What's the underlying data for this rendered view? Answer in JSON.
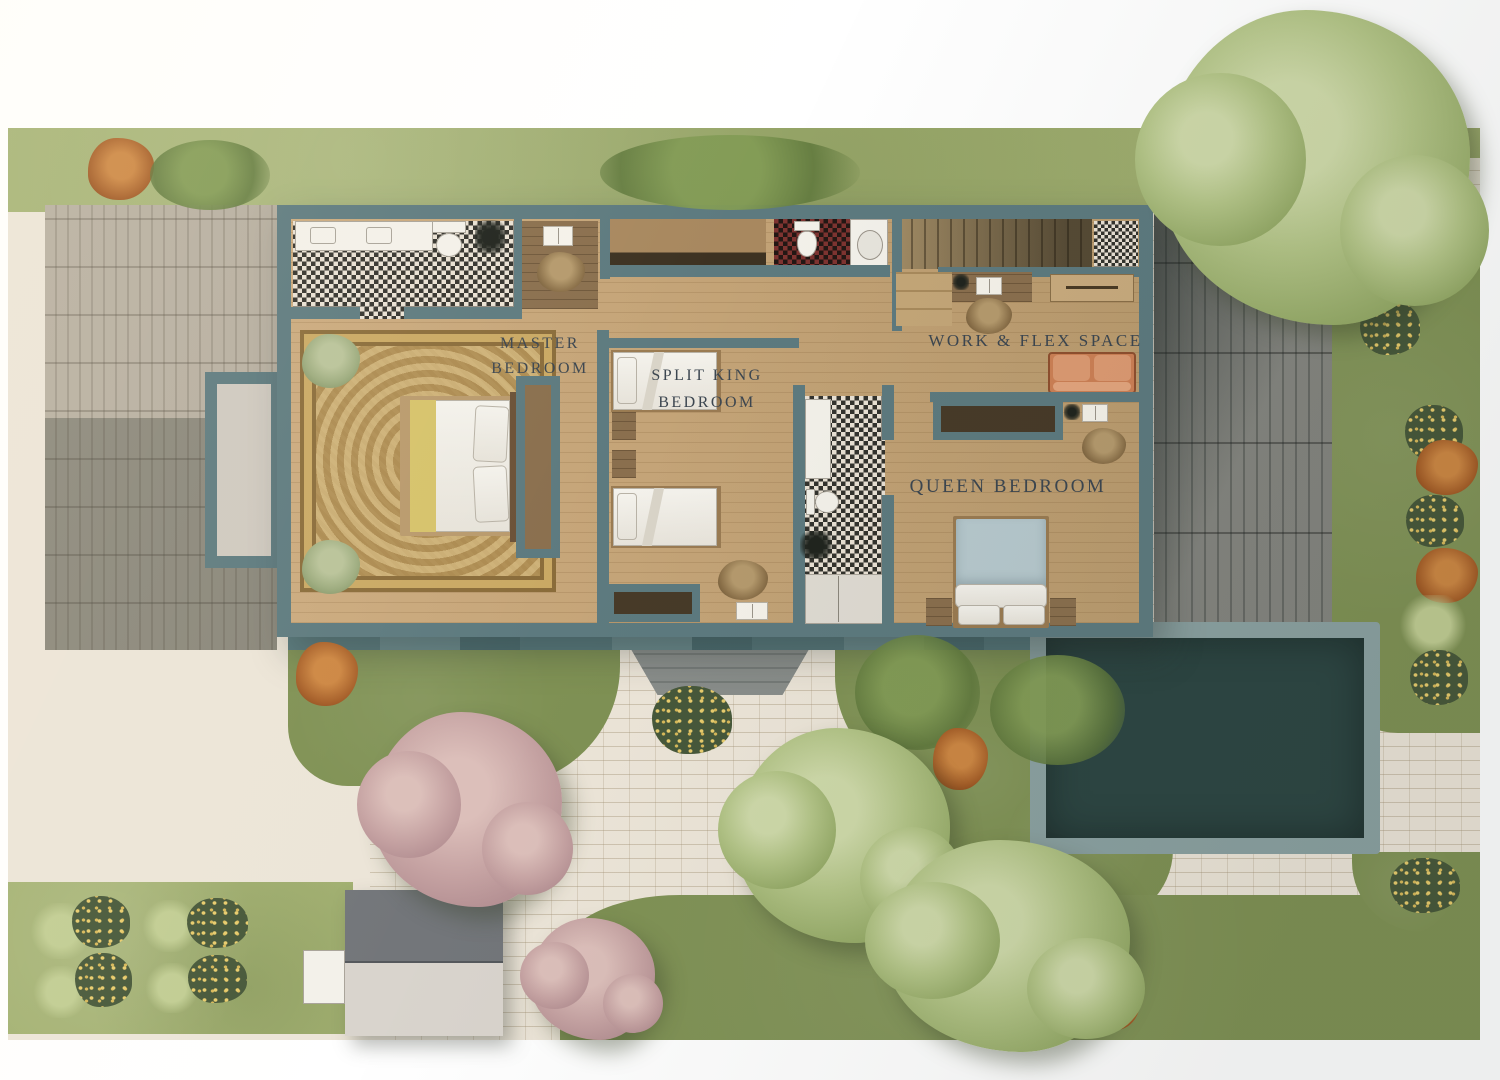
{
  "page": {
    "type": "residential-floor-plan-site-rendering"
  },
  "labels": {
    "master": {
      "line1": "MASTER",
      "line2": "BEDROOM"
    },
    "split_king": {
      "line1": "SPLIT KING",
      "line2": "BEDROOM"
    },
    "work_flex": {
      "line1": "WORK & FLEX SPACE"
    },
    "queen": {
      "line1": "QUEEN BEDROOM"
    }
  },
  "colors": {
    "wall": "#5d7a7f",
    "wood": "#c3a276",
    "wood_dark": "#8a6f4e",
    "grass": "#a3b172",
    "grass_dark": "#7f9154",
    "ground": "#ece5d8",
    "paver_gray": "#b2aa9c",
    "slate": "#83847e",
    "pool_water": "#2d4643",
    "pool_coping": "#8ba1a1",
    "checker_dark": "#33322d",
    "checker_light": "#e9e1d4",
    "checker_red": "#7e3330",
    "rug": "#c2a368",
    "sofa": "#cd8055",
    "chair_green": "#9cab7e",
    "duvet_blue": "#b7c9ce",
    "label": "#3c4650"
  }
}
